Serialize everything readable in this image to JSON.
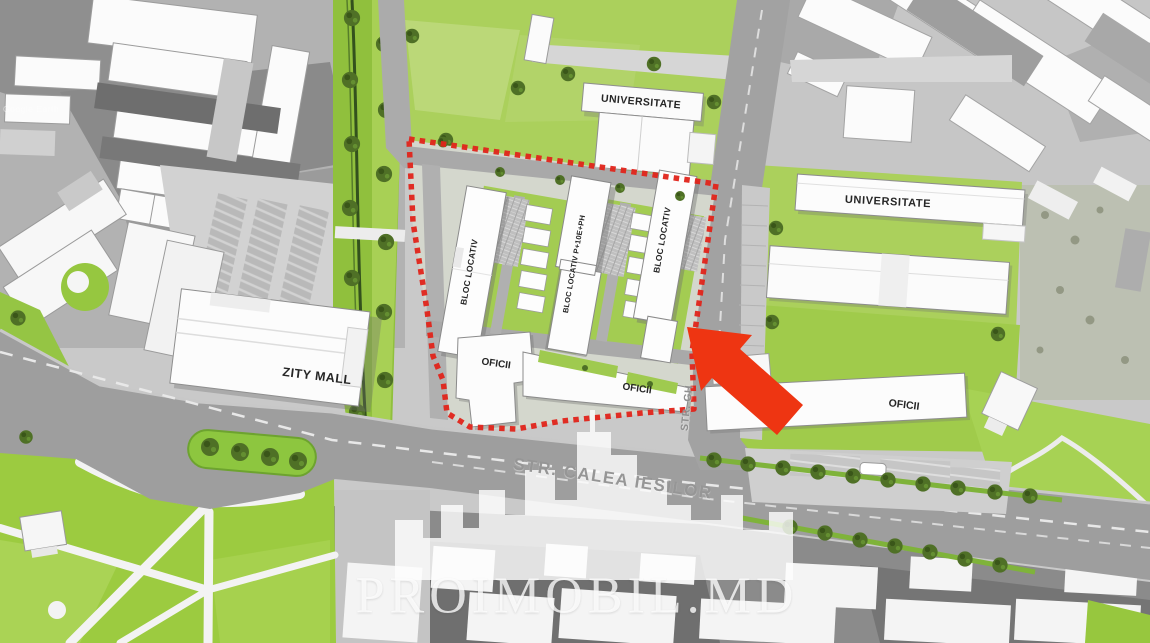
{
  "map": {
    "type": "development-site-plan",
    "watermark": {
      "brand": "PROIMOBIL.MD",
      "attribution": "Google Earth"
    },
    "labels": {
      "universitate_top": "UNIVERSITATE",
      "universitate_east": "UNIVERSITATE",
      "zity_mall": "ZITY MALL",
      "bloc_locativ_west": "BLOC LOCATIV",
      "bloc_locativ_center": "BLOC LOCATIV P+10E+PH",
      "bloc_locativ_east": "BLOC LOCATIV",
      "oficii_site_west": "OFICII",
      "oficii_site_east": "OFICII",
      "oficii_east": "OFICII",
      "street_main": "STR. CALEA IESILOR",
      "street_side": "STR. GH"
    },
    "colors": {
      "site_outline_red": "#e0241a",
      "arrow_red": "#ee3512",
      "lawn_green": "#abd05c",
      "park_green": "#9ccb40",
      "tree_green": "#4f7026",
      "road_gray": "#9e9e9e",
      "building_white": "#fcfcfc",
      "photo_gray": "#b2b2b2"
    }
  }
}
